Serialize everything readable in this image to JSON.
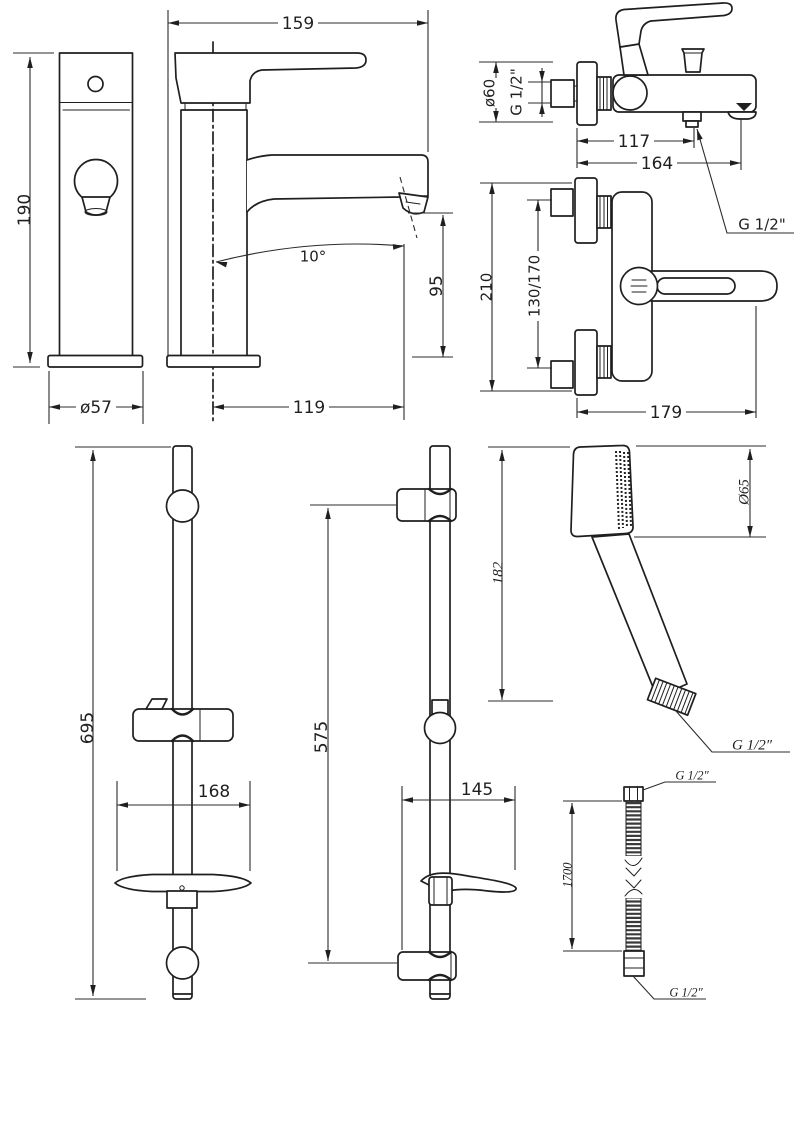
{
  "drawing": {
    "background": "#ffffff",
    "line_color": "#1f1f1f",
    "views": {
      "basin_front": {
        "height": "190",
        "base_diameter": "ø57"
      },
      "basin_side": {
        "length": "159",
        "spout_angle": "10°",
        "spout_height": "95",
        "spout_reach": "119"
      },
      "bath_side": {
        "escutcheon_diameter": "ø60",
        "inlet_thread": "G 1/2\"",
        "outlet_offset": "117",
        "length": "164",
        "hose_outlet_thread": "G 1/2\""
      },
      "bath_front": {
        "height": "210",
        "inlet_centers": "130/170",
        "width": "179"
      },
      "rail_long": {
        "length": "695",
        "soap_dish_width": "168"
      },
      "rail_short": {
        "length": "575",
        "shelf_width": "145"
      },
      "hand_shower": {
        "length": "182",
        "head_diameter": "Ø65",
        "thread": "G 1/2″"
      },
      "hose": {
        "length": "1700",
        "thread_top": "G 1/2″",
        "thread_bottom": "G 1/2″"
      }
    }
  }
}
